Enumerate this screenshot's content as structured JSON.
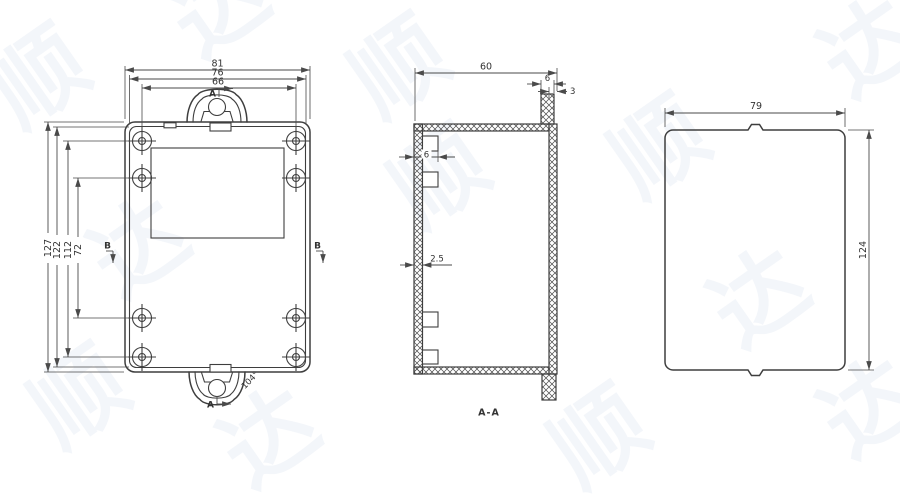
{
  "title": "enclosure-three-view-technical-drawing",
  "views": {
    "front": {
      "dim_overall_width": "81",
      "dim_lid_width": "76",
      "dim_hole_span_width": "66",
      "dim_overall_height": "127",
      "dim_lid_height": "122",
      "dim_hole_span_outer": "112",
      "dim_hole_span_inner": "72",
      "dim_tab_angle": "104°",
      "marker_a_top": "A",
      "marker_a_bottom": "A",
      "marker_b_left": "B",
      "marker_b_right": "B"
    },
    "section": {
      "label": "A-A",
      "dim_depth": "60",
      "dim_flange_width": "6",
      "dim_flange_thickness": "3",
      "dim_boss_depth": "6",
      "dim_wall_thickness": "2.5"
    },
    "side": {
      "dim_width": "79",
      "dim_height": "124"
    }
  },
  "colors": {
    "line": "#3e3e3e",
    "dim_line": "#4a4a4a",
    "text": "#333333",
    "background": "#ffffff",
    "watermark": "#eef2f8"
  },
  "watermark": {
    "glyphs": [
      "顺",
      "达"
    ]
  }
}
